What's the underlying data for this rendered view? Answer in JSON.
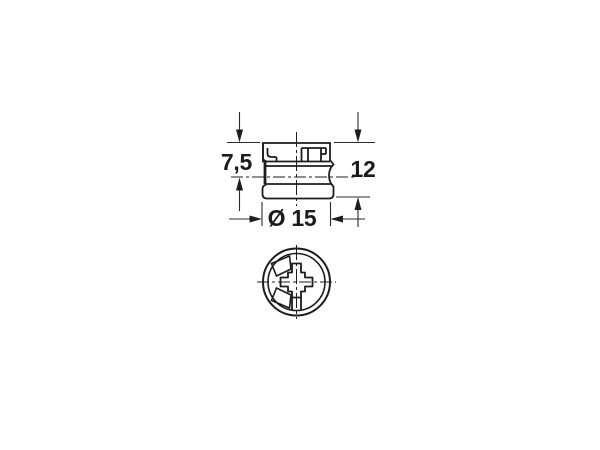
{
  "drawing": {
    "dimensions": {
      "flange_to_axis": {
        "label": "7,5"
      },
      "overall_height": {
        "label": "12"
      },
      "diameter": {
        "label": "Ø 15"
      }
    },
    "colors": {
      "line": "#1d1d1d",
      "dimension_line": "#2a2a2a",
      "background": "#ffffff"
    }
  }
}
